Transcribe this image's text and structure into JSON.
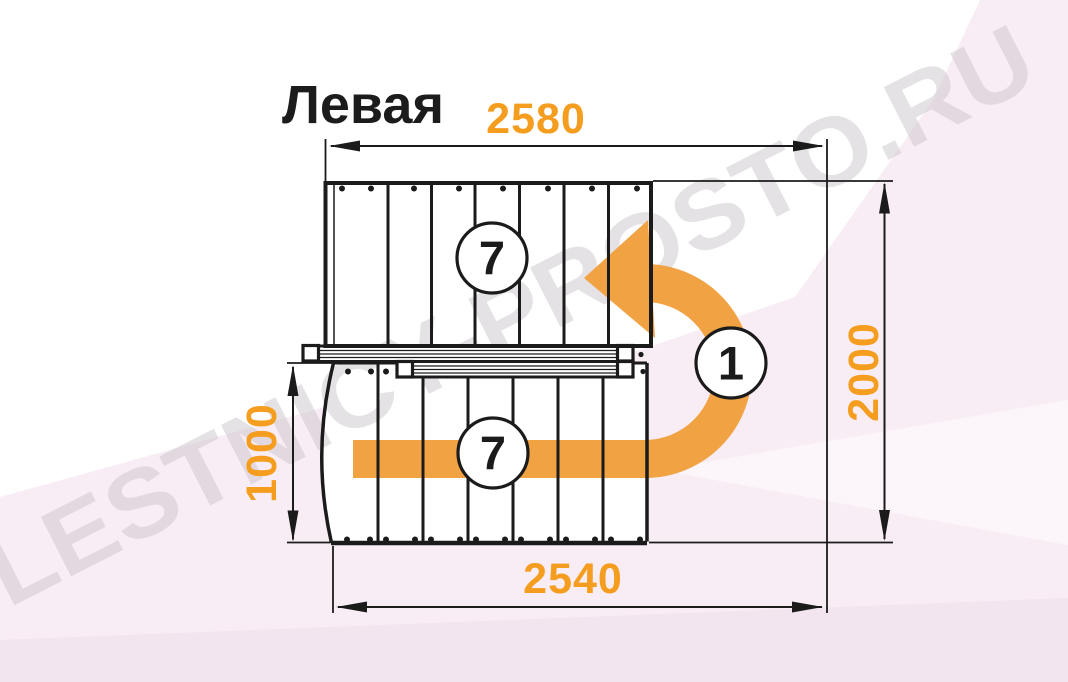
{
  "diagram": {
    "title": "Левая",
    "watermark": "LESTNICY-PROSTO.RU",
    "dimensions": {
      "top_width": "2580",
      "bottom_width": "2540",
      "right_height": "2000",
      "left_height": "1000"
    },
    "step_counts": {
      "upper_flight": "7",
      "lower_flight": "7",
      "turn_landing": "1"
    },
    "colors": {
      "dimension_text": "#F59D1F",
      "arrow_orange": "#F1A243",
      "line_black": "#1B1B1B",
      "background_pink": "#F8EDF4",
      "watermark_gray": "#CFC8CF"
    }
  }
}
